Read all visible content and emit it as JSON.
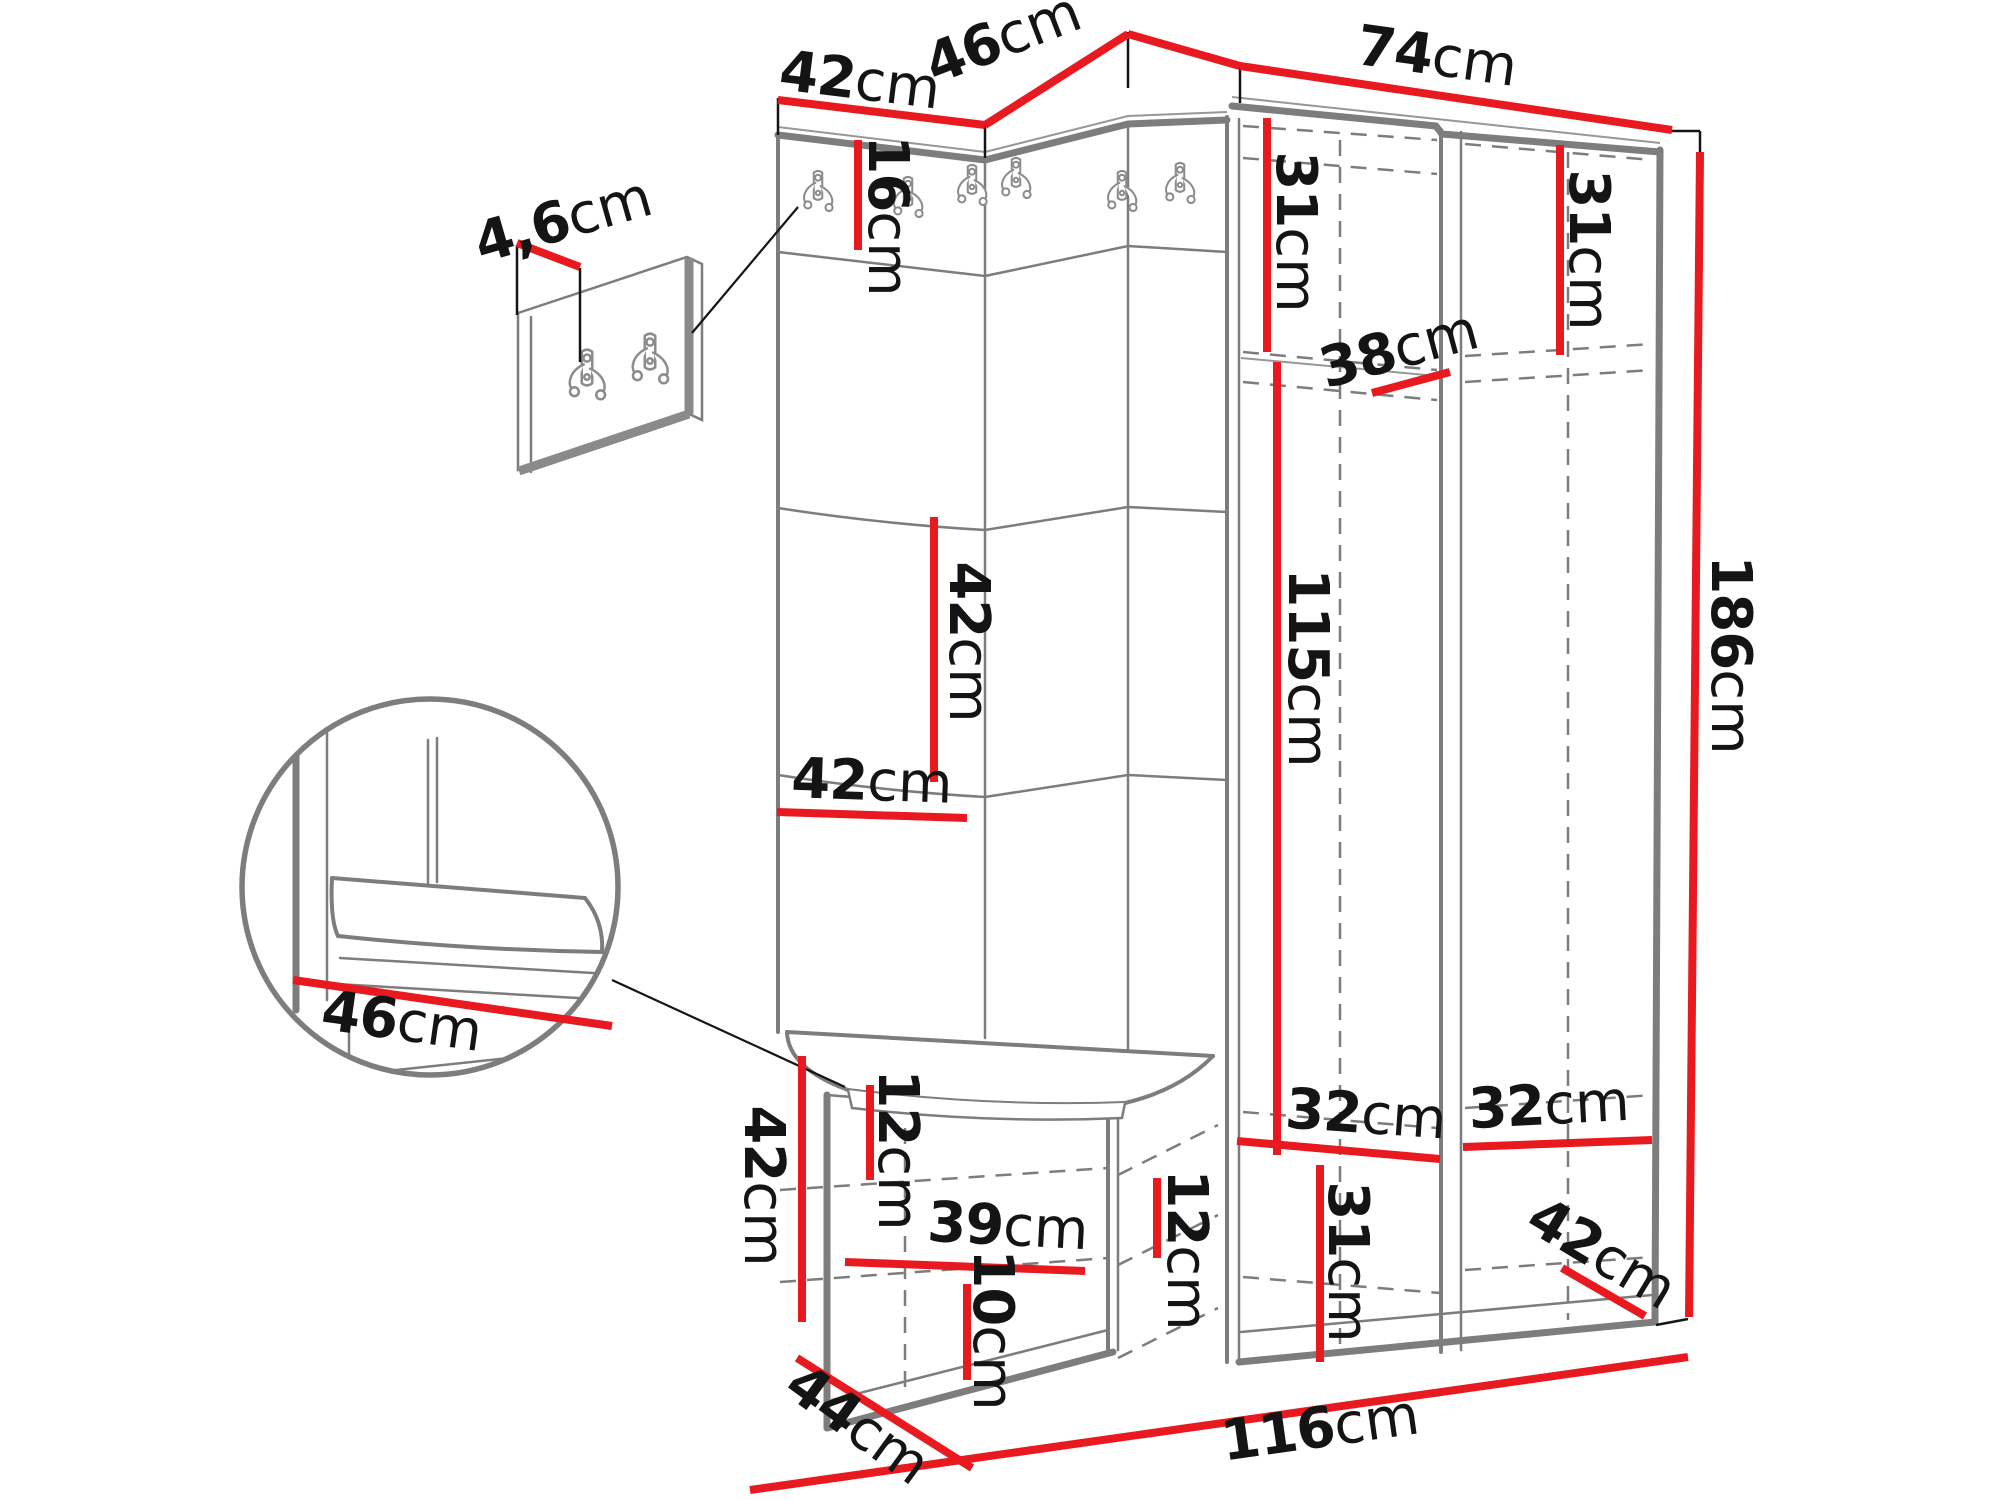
{
  "diagram": {
    "title": "hallway-furniture-dimension-diagram",
    "unit": "cm",
    "colors": {
      "dimension": "#e8191f",
      "outline": "#7d7d7d",
      "outline_dark": "#5f5f5f",
      "text": "#141414",
      "background": "#ffffff"
    },
    "dimensions": [
      {
        "id": "top-width-left",
        "value": "42",
        "unit": "cm",
        "label": {
          "x": 860,
          "y": 80,
          "rot": 7
        },
        "lines": [
          [
            778,
            100,
            985,
            125
          ]
        ],
        "ticks": [
          [
            778,
            98,
            778,
            135
          ],
          [
            985,
            122,
            985,
            158
          ]
        ]
      },
      {
        "id": "top-depth-corner",
        "value": "46",
        "unit": "cm",
        "label": {
          "x": 1003,
          "y": 38,
          "rot": -21
        },
        "lines": [
          [
            985,
            125,
            1128,
            34
          ],
          [
            1128,
            34,
            1240,
            66
          ]
        ],
        "ticks": [
          [
            1128,
            32,
            1128,
            88
          ],
          [
            1240,
            64,
            1240,
            103
          ]
        ]
      },
      {
        "id": "top-width-right",
        "value": "74",
        "unit": "cm",
        "label": {
          "x": 1437,
          "y": 56,
          "rot": 8
        },
        "lines": [
          [
            1240,
            66,
            1672,
            130
          ]
        ],
        "ticks": [
          [
            1668,
            131,
            1700,
            131
          ],
          [
            1700,
            131,
            1700,
            152
          ]
        ]
      },
      {
        "id": "height-total",
        "value": "186",
        "unit": "cm",
        "label": {
          "x": 1731,
          "y": 655,
          "rot": 90
        },
        "lines": [
          [
            1700,
            152,
            1689,
            1317
          ]
        ],
        "ticks": [
          [
            1688,
            1319,
            1656,
            1325
          ]
        ]
      },
      {
        "id": "hook-strip-height",
        "value": "16",
        "unit": "cm",
        "label": {
          "x": 888,
          "y": 216,
          "rot": 90
        },
        "lines": [
          [
            858,
            140,
            858,
            250
          ]
        ],
        "ticks": []
      },
      {
        "id": "panel-square-height",
        "value": "42",
        "unit": "cm",
        "label": {
          "x": 969,
          "y": 642,
          "rot": 90
        },
        "lines": [
          [
            934,
            517,
            934,
            782
          ]
        ],
        "ticks": []
      },
      {
        "id": "panel-square-width",
        "value": "42",
        "unit": "cm",
        "label": {
          "x": 872,
          "y": 781,
          "rot": 2
        },
        "lines": [
          [
            777,
            812,
            967,
            818
          ]
        ],
        "ticks": []
      },
      {
        "id": "wardrobe-top-left-height",
        "value": "31",
        "unit": "cm",
        "label": {
          "x": 1296,
          "y": 232,
          "rot": 90
        },
        "lines": [
          [
            1267,
            118,
            1267,
            352
          ]
        ],
        "ticks": []
      },
      {
        "id": "wardrobe-top-right-height",
        "value": "31",
        "unit": "cm",
        "label": {
          "x": 1589,
          "y": 250,
          "rot": 90
        },
        "lines": [
          [
            1560,
            145,
            1560,
            355
          ]
        ],
        "ticks": []
      },
      {
        "id": "shelf-depth",
        "value": "38",
        "unit": "cm",
        "label": {
          "x": 1399,
          "y": 349,
          "rot": -15
        },
        "lines": [
          [
            1372,
            393,
            1450,
            372
          ]
        ],
        "ticks": []
      },
      {
        "id": "hanging-space-height",
        "value": "115",
        "unit": "cm",
        "label": {
          "x": 1308,
          "y": 668,
          "rot": 90
        },
        "lines": [
          [
            1277,
            362,
            1277,
            1155
          ]
        ],
        "ticks": []
      },
      {
        "id": "bench-height",
        "value": "42",
        "unit": "cm",
        "label": {
          "x": 764,
          "y": 1186,
          "rot": 90
        },
        "lines": [
          [
            802,
            1056,
            802,
            1322
          ]
        ],
        "ticks": []
      },
      {
        "id": "seat-depth-detail",
        "value": "46",
        "unit": "cm",
        "label": {
          "x": 402,
          "y": 1021,
          "rot": 8
        },
        "lines": [
          [
            293,
            980,
            612,
            1026
          ]
        ],
        "ticks": []
      },
      {
        "id": "hook-plate-thickness",
        "value": "4,6",
        "unit": "cm",
        "label": {
          "x": 563,
          "y": 220,
          "rot": -16
        },
        "lines": [
          [
            517,
            243,
            580,
            267
          ]
        ],
        "ticks": [
          [
            517,
            245,
            517,
            315
          ],
          [
            580,
            268,
            580,
            362
          ]
        ]
      },
      {
        "id": "bench-gap-top",
        "value": "12",
        "unit": "cm",
        "label": {
          "x": 898,
          "y": 1150,
          "rot": 90
        },
        "lines": [
          [
            870,
            1085,
            870,
            1180
          ]
        ],
        "ticks": []
      },
      {
        "id": "bench-inner-width",
        "value": "39",
        "unit": "cm",
        "label": {
          "x": 1008,
          "y": 1226,
          "rot": 3
        },
        "lines": [
          [
            845,
            1262,
            1085,
            1271
          ]
        ],
        "ticks": []
      },
      {
        "id": "bench-gap-middle",
        "value": "12",
        "unit": "cm",
        "label": {
          "x": 1187,
          "y": 1250,
          "rot": 90
        },
        "lines": [
          [
            1157,
            1178,
            1157,
            1258
          ]
        ],
        "ticks": []
      },
      {
        "id": "bench-gap-bottom",
        "value": "10",
        "unit": "cm",
        "label": {
          "x": 993,
          "y": 1330,
          "rot": 90
        },
        "lines": [
          [
            967,
            1284,
            967,
            1380
          ]
        ],
        "ticks": []
      },
      {
        "id": "wardrobe-bottom-left-width",
        "value": "32",
        "unit": "cm",
        "label": {
          "x": 1366,
          "y": 1114,
          "rot": 4
        },
        "lines": [
          [
            1237,
            1141,
            1440,
            1159
          ]
        ],
        "ticks": []
      },
      {
        "id": "wardrobe-bottom-right-width",
        "value": "32",
        "unit": "cm",
        "label": {
          "x": 1549,
          "y": 1105,
          "rot": -3
        },
        "lines": [
          [
            1463,
            1147,
            1652,
            1140
          ]
        ],
        "ticks": []
      },
      {
        "id": "wardrobe-bottom-height",
        "value": "31",
        "unit": "cm",
        "label": {
          "x": 1348,
          "y": 1262,
          "rot": 90
        },
        "lines": [
          [
            1320,
            1165,
            1320,
            1362
          ]
        ],
        "ticks": []
      },
      {
        "id": "total-width",
        "value": "116",
        "unit": "cm",
        "label": {
          "x": 1320,
          "y": 1428,
          "rot": -8
        },
        "lines": [
          [
            750,
            1490,
            1688,
            1357
          ]
        ],
        "ticks": []
      },
      {
        "id": "bench-depth",
        "value": "44",
        "unit": "cm",
        "label": {
          "x": 858,
          "y": 1424,
          "rot": 36
        },
        "lines": [
          [
            797,
            1358,
            972,
            1468
          ]
        ],
        "ticks": []
      },
      {
        "id": "wardrobe-depth",
        "value": "42",
        "unit": "cm",
        "label": {
          "x": 1602,
          "y": 1253,
          "rot": 31
        },
        "lines": [
          [
            1562,
            1268,
            1645,
            1316
          ]
        ],
        "ticks": []
      }
    ],
    "hooks": {
      "main_unit": [
        {
          "x": 818,
          "y": 176
        },
        {
          "x": 908,
          "y": 182
        },
        {
          "x": 972,
          "y": 170
        },
        {
          "x": 1016,
          "y": 163
        },
        {
          "x": 1122,
          "y": 176
        },
        {
          "x": 1180,
          "y": 168
        }
      ],
      "wall_detail": [
        {
          "x": 587,
          "y": 356
        },
        {
          "x": 650,
          "y": 340
        }
      ]
    },
    "pointers": [
      {
        "name": "hook-panel-pointer",
        "line": [
          692,
          333,
          798,
          207
        ]
      },
      {
        "name": "seat-detail-pointer",
        "line": [
          612,
          980,
          845,
          1087
        ]
      }
    ]
  }
}
